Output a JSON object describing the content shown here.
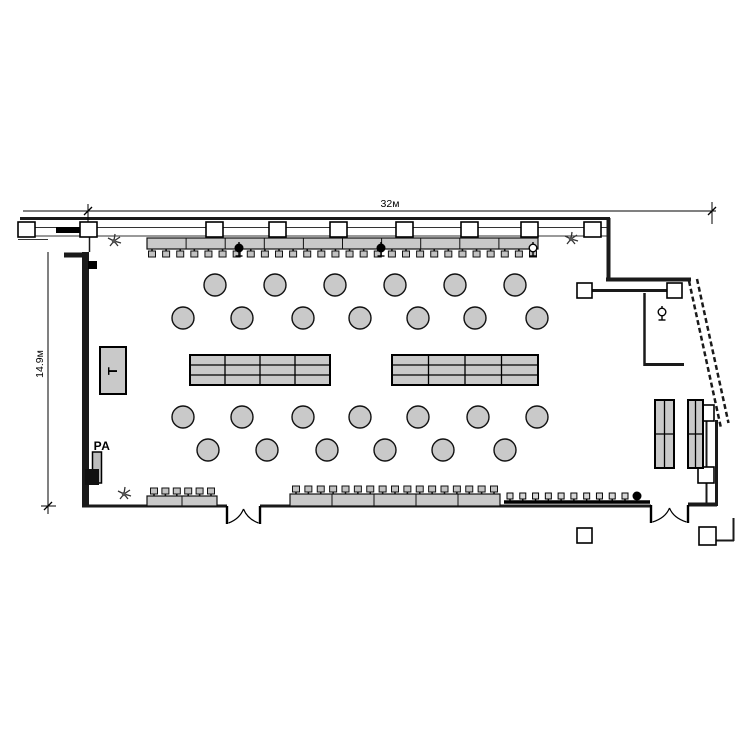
{
  "diagram": {
    "type": "floor-plan",
    "dimensions": {
      "width_label": "32м",
      "height_label": "14.9м"
    },
    "labels": {
      "stage": "T",
      "speaker": "PA"
    },
    "colors": {
      "background": "#ffffff",
      "furniture_fill": "#c9c9c9",
      "outline": "#111111",
      "wall": "#1a1a1a"
    },
    "counts": {
      "round_tables": 26,
      "banquet_tables": 2,
      "side_tables": 2,
      "buffet_tables": 3,
      "wall_columns_top": 9,
      "wall_columns_right": 5,
      "plants": 3,
      "microphones": 5,
      "double_doors": 2
    },
    "round_tables": {
      "radius": 11,
      "rows": [
        {
          "y": 285,
          "x": [
            215,
            275,
            335,
            395,
            455,
            515
          ]
        },
        {
          "y": 318,
          "x": [
            183,
            242,
            303,
            360,
            418,
            475,
            537
          ]
        },
        {
          "y": 417,
          "x": [
            183,
            242,
            303,
            360,
            418,
            478,
            537
          ]
        },
        {
          "y": 450,
          "x": [
            208,
            267,
            327,
            385,
            443,
            505
          ]
        }
      ]
    },
    "banquet_tables": [
      {
        "x": 190,
        "y": 355,
        "w": 140,
        "h": 30,
        "cols": 4,
        "rows": 3
      },
      {
        "x": 392,
        "y": 355,
        "w": 146,
        "h": 30,
        "cols": 4,
        "rows": 3
      }
    ],
    "side_tables": [
      {
        "x": 655,
        "y": 400,
        "w": 19,
        "h": 68,
        "cols": 2,
        "rows": 2
      },
      {
        "x": 688,
        "y": 400,
        "w": 15,
        "h": 68,
        "cols": 2,
        "rows": 2
      }
    ],
    "buffets": [
      {
        "name": "top-buffet",
        "x": 147,
        "y": 238,
        "w": 391,
        "h": 11,
        "segments": 10,
        "stools": {
          "side": "bottom",
          "count": 28,
          "x1": 152,
          "x2": 533
        }
      },
      {
        "name": "bottom-left-buffet",
        "x": 147,
        "y": 496,
        "w": 70,
        "h": 10,
        "segments": 2,
        "stools": {
          "side": "top",
          "count": 6,
          "x1": 154,
          "x2": 211
        }
      },
      {
        "name": "bottom-mid-buffet",
        "x": 290,
        "y": 494,
        "w": 210,
        "h": 12,
        "segments": 5,
        "stools": {
          "side": "top",
          "count": 17,
          "x1": 296,
          "x2": 494
        }
      }
    ],
    "counter": {
      "x1": 504,
      "y": 502,
      "x2": 650,
      "stools": {
        "count": 10,
        "x1": 510,
        "x2": 625
      }
    },
    "structures": {
      "top_columns": {
        "y": 222,
        "w": 17,
        "h": 15,
        "x": [
          18,
          80,
          206,
          269,
          330,
          396,
          461,
          521,
          584
        ]
      },
      "right_columns": [
        {
          "x": 577,
          "y": 283,
          "w": 15,
          "h": 15
        },
        {
          "x": 667,
          "y": 283,
          "w": 15,
          "h": 15
        },
        {
          "x": 698,
          "y": 405,
          "w": 16,
          "h": 16
        },
        {
          "x": 698,
          "y": 467,
          "w": 16,
          "h": 16
        },
        {
          "x": 699,
          "y": 527,
          "w": 17,
          "h": 18
        }
      ],
      "freestanding_box": {
        "x": 577,
        "y": 528,
        "w": 15,
        "h": 15
      }
    },
    "doors": [
      {
        "x1": 227,
        "x2": 260,
        "y": 506
      },
      {
        "x1": 651,
        "x2": 688,
        "y": 505
      }
    ],
    "plants": [
      {
        "x": 114,
        "y": 241
      },
      {
        "x": 571,
        "y": 239
      },
      {
        "x": 124,
        "y": 494
      }
    ],
    "microphones": [
      {
        "x": 533,
        "y": 250,
        "filled": false
      },
      {
        "x": 662,
        "y": 314,
        "filled": false
      },
      {
        "x": 239,
        "y": 250,
        "filled": true
      },
      {
        "x": 381,
        "y": 250,
        "filled": true
      },
      {
        "x": 637,
        "y": 496,
        "type": "dot"
      }
    ],
    "stage": {
      "x": 100,
      "y": 347,
      "w": 26,
      "h": 47
    },
    "pa_speaker": {
      "x": 92.5,
      "y": 452,
      "w": 9,
      "h": 31
    }
  }
}
